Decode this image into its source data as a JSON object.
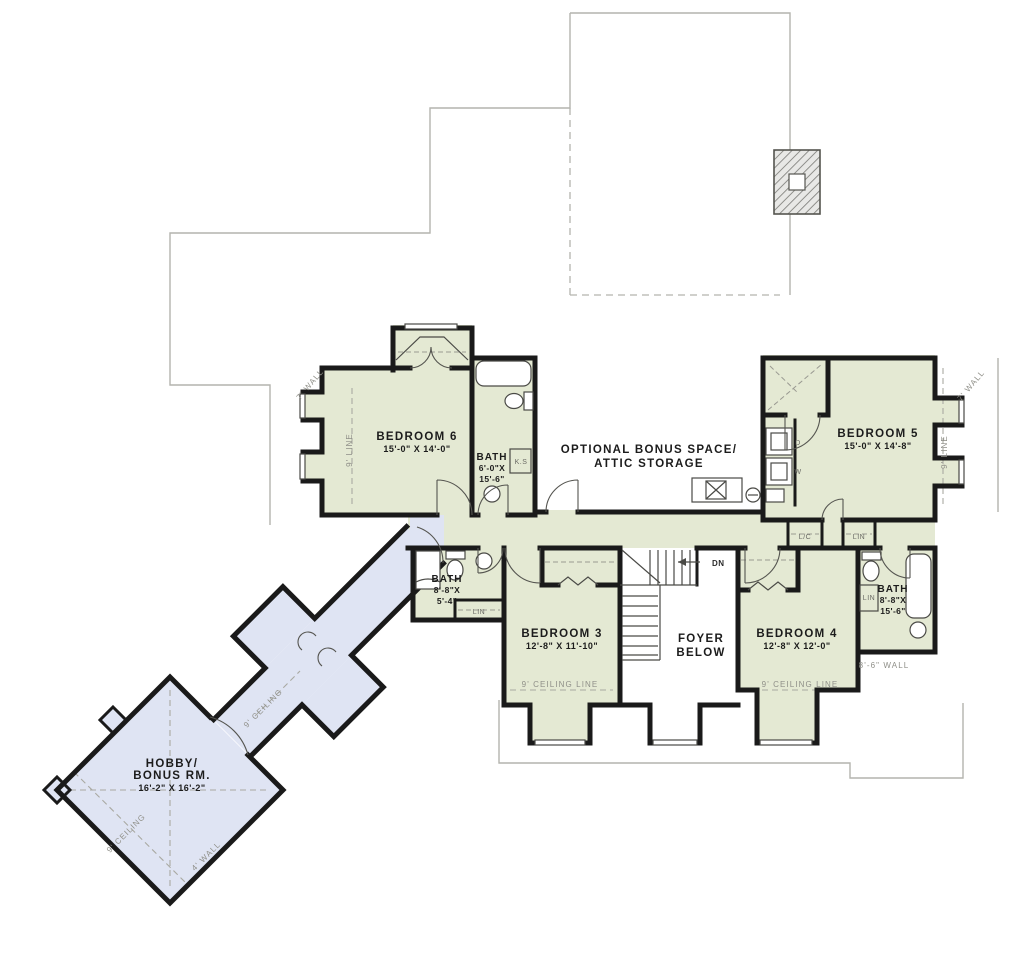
{
  "rooms": {
    "bedroom6": {
      "name": "BEDROOM 6",
      "dims": "15'-0\" X 14'-0\""
    },
    "bath6": {
      "name": "BATH",
      "w": "6'-0\"X",
      "l": "15'-6\""
    },
    "bonus_space": {
      "line1": "OPTIONAL BONUS SPACE/",
      "line2": "ATTIC STORAGE"
    },
    "bedroom5": {
      "name": "BEDROOM 5",
      "dims": "15'-0\" X 14'-8\""
    },
    "bath_left": {
      "name": "BATH",
      "w": "8'-8\"X",
      "l": "5'-4\""
    },
    "bedroom3": {
      "name": "BEDROOM 3",
      "dims": "12'-8\" X 11'-10\""
    },
    "foyer": {
      "line1": "FOYER",
      "line2": "BELOW"
    },
    "bedroom4": {
      "name": "BEDROOM 4",
      "dims": "12'-8\" X 12'-0\""
    },
    "bath_right": {
      "name": "BATH",
      "w": "8'-8\"X",
      "l": "15'-6\""
    },
    "hobby": {
      "line1": "HOBBY/",
      "line2": "BONUS RM.",
      "dims": "16'-2\" X 16'-2\""
    }
  },
  "annotations": {
    "wall7_left": "7' WALL",
    "wall7_right": "7' WALL",
    "line9_left": "9' LINE",
    "line9_right": "9' LINE",
    "ceiling_line_left": "9' CEILING LINE",
    "ceiling_line_right": "9' CEILING LINE",
    "wall86": "8'-6\" WALL",
    "wall4": "4' WALL",
    "ceiling9_hall": "9' CEILING",
    "ceiling9_hobby": "9' CEILING",
    "down": "DN",
    "linen_short": "L/C",
    "linen1": "LIN",
    "linen2": "LIN",
    "linen3": "LIN",
    "washer": "W",
    "dryer": "D",
    "knee_space": "K.S"
  },
  "colors": {
    "room_fill": "#e4e9d3",
    "hall_fill": "#dfe4f3",
    "wall": "#1a1a1a",
    "roofline": "#b4b4ae"
  }
}
